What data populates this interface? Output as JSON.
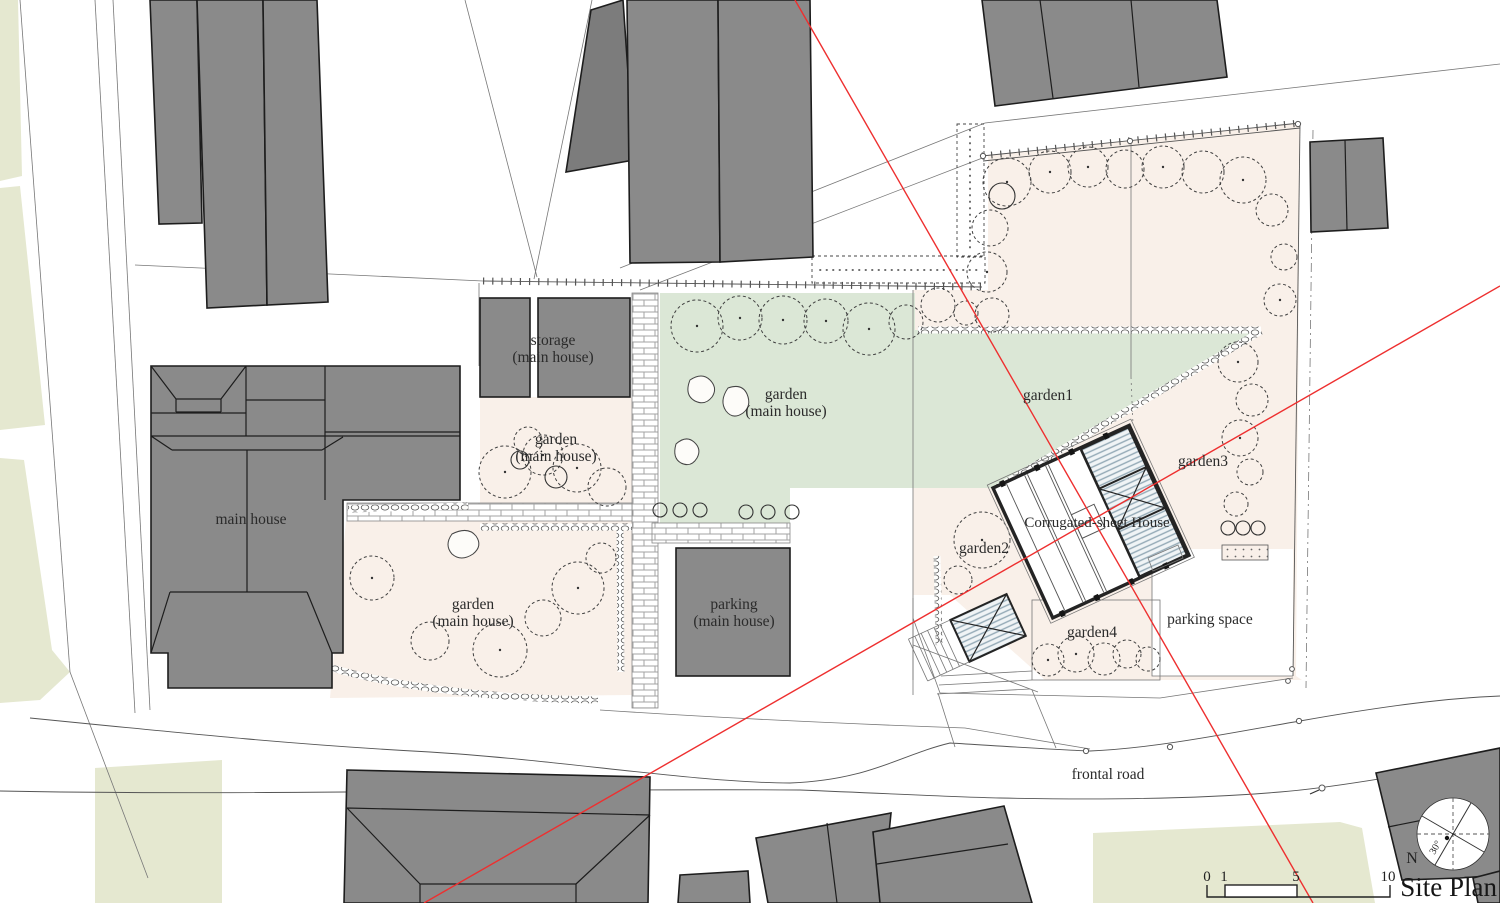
{
  "title": "Site Plan",
  "labels": {
    "main_house": "main house",
    "storage_1": "storage",
    "storage_2": "(main house)",
    "garden_green_1": "garden",
    "garden_green_2": "(main house)",
    "garden_upper_1": "garden",
    "garden_upper_2": "(main house)",
    "garden_lower_1": "garden",
    "garden_lower_2": "(main house)",
    "parking_1": "parking",
    "parking_2": "(main house)",
    "garden1": "garden1",
    "garden2": "garden2",
    "garden3": "garden3",
    "garden4": "garden4",
    "house": "Corrugated-sheet House",
    "parking_space": "parking space",
    "frontal_road": "frontal road"
  },
  "compass": {
    "north_label": "N",
    "rotation_label": "30°"
  },
  "scale_bar": {
    "tick_0": "0",
    "tick_1": "1",
    "tick_5": "5",
    "tick_10": "10"
  },
  "colors": {
    "building_gray": "#8a8a8a",
    "garden_pink": "#f9f0e9",
    "garden_green": "#dbe7d6",
    "open_field_green": "#e5e8d0",
    "sight_line_red": "#ee2f2f",
    "deck_hatch_blue": "#93a9b6"
  }
}
